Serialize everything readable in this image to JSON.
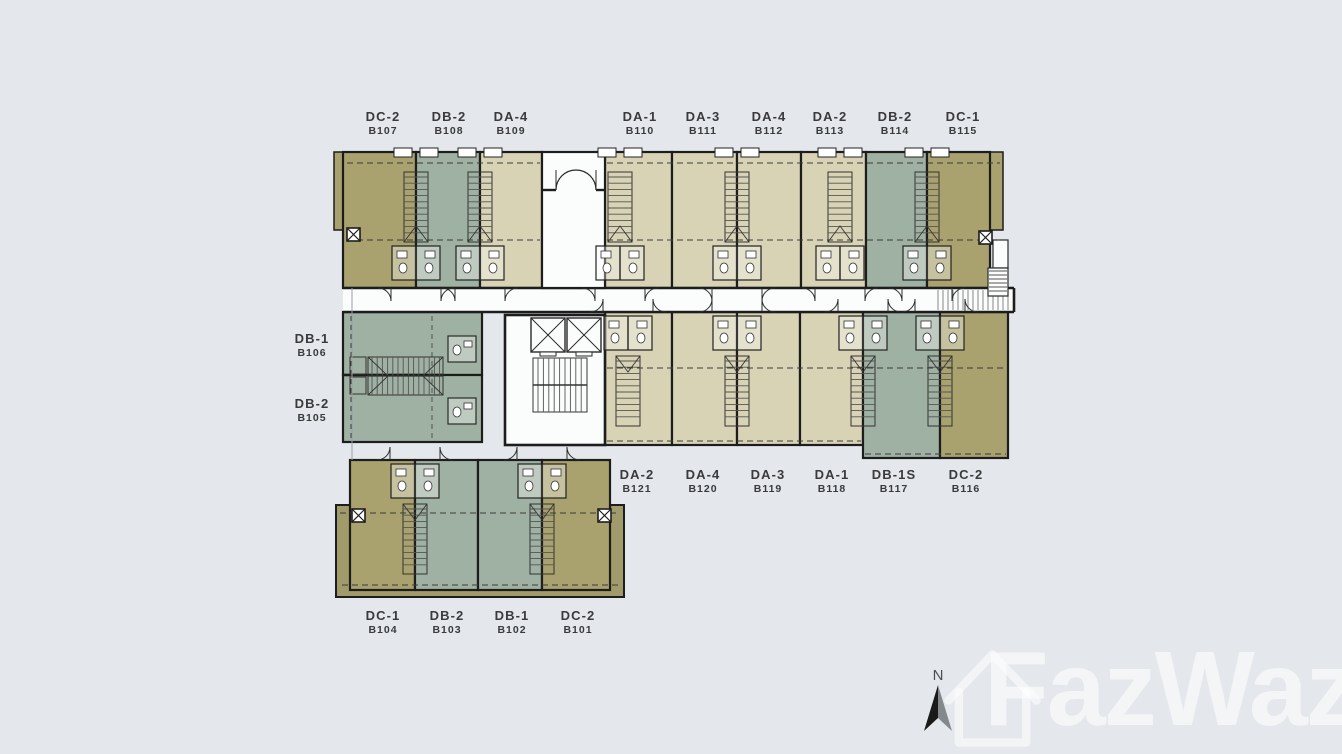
{
  "title_block": {
    "north_label": "N",
    "building": "BUILDING B",
    "floor": "GROUND FLOOR PLAN"
  },
  "watermark": {
    "text": "FazWaz"
  },
  "colors": {
    "background": "#e4e8ec",
    "wall": "#1d1d1d",
    "corridor_white": "#fbfcfc",
    "unit_da": "#d8d3b4",
    "unit_db": "#9fb1a2",
    "unit_dc": "#a9a16e",
    "outer_olive": "#a19a6a",
    "label_text": "#3a3a3c",
    "title_text": "#26282c",
    "subtitle_text": "#3d4145",
    "north_arrow_dark": "#1a1a1a",
    "north_arrow_light": "#83888d"
  },
  "units": {
    "top_row": [
      {
        "model": "DC-2",
        "number": "B107"
      },
      {
        "model": "DB-2",
        "number": "B108"
      },
      {
        "model": "DA-4",
        "number": "B109"
      },
      {
        "model": "DA-1",
        "number": "B110"
      },
      {
        "model": "DA-3",
        "number": "B111"
      },
      {
        "model": "DA-4",
        "number": "B112"
      },
      {
        "model": "DA-2",
        "number": "B113"
      },
      {
        "model": "DB-2",
        "number": "B114"
      },
      {
        "model": "DC-1",
        "number": "B115"
      }
    ],
    "left_column": [
      {
        "model": "DB-1",
        "number": "B106"
      },
      {
        "model": "DB-2",
        "number": "B105"
      }
    ],
    "middle_row": [
      {
        "model": "DA-2",
        "number": "B121"
      },
      {
        "model": "DA-4",
        "number": "B120"
      },
      {
        "model": "DA-3",
        "number": "B119"
      },
      {
        "model": "DA-1",
        "number": "B118"
      },
      {
        "model": "DB-1S",
        "number": "B117"
      },
      {
        "model": "DC-2",
        "number": "B116"
      }
    ],
    "bottom_row": [
      {
        "model": "DC-1",
        "number": "B104"
      },
      {
        "model": "DB-2",
        "number": "B103"
      },
      {
        "model": "DB-1",
        "number": "B102"
      },
      {
        "model": "DC-2",
        "number": "B101"
      }
    ]
  }
}
